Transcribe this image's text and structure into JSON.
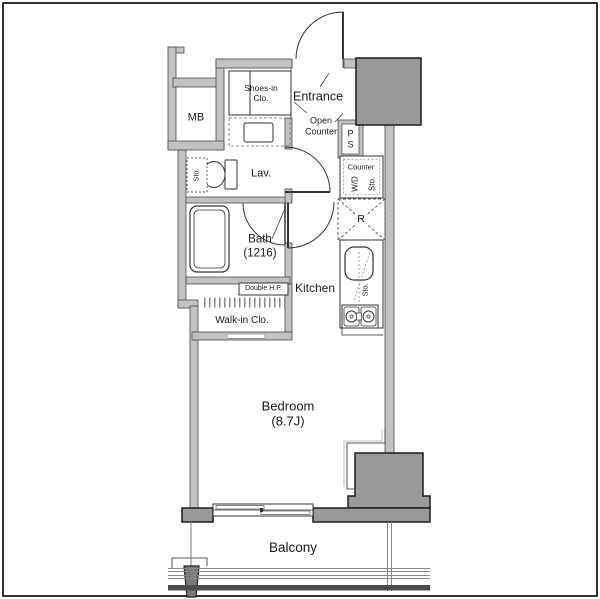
{
  "labels": {
    "mb": "MB",
    "shoes_line1": "Shoes-in",
    "shoes_line2": "Clo.",
    "entrance": "Entrance",
    "open_counter_line1": "Open",
    "open_counter_line2": "Counter",
    "ps_line1": "P",
    "ps_line2": "S",
    "counter": "Counter",
    "washer_dryer": "W/D",
    "counter_storage": "Sto.",
    "lavatory": "Lav.",
    "lavatory_storage": "Sto.",
    "bath_line1": "Bath",
    "bath_line2": "(1216)",
    "refrigerator": "R",
    "kitchen": "Kitchen",
    "kitchen_storage": "Sto.",
    "double_hanger_pipe": "Double H.P.",
    "walk_in_closet": "Walk-in Clo.",
    "bedroom_line1": "Bedroom",
    "bedroom_line2": "(8.7J)",
    "balcony": "Balcony"
  },
  "colors": {
    "wall_fill": "#c2c2c2",
    "column_fill": "#999999",
    "outline": "#3a3a3a",
    "background": "#ffffff"
  }
}
